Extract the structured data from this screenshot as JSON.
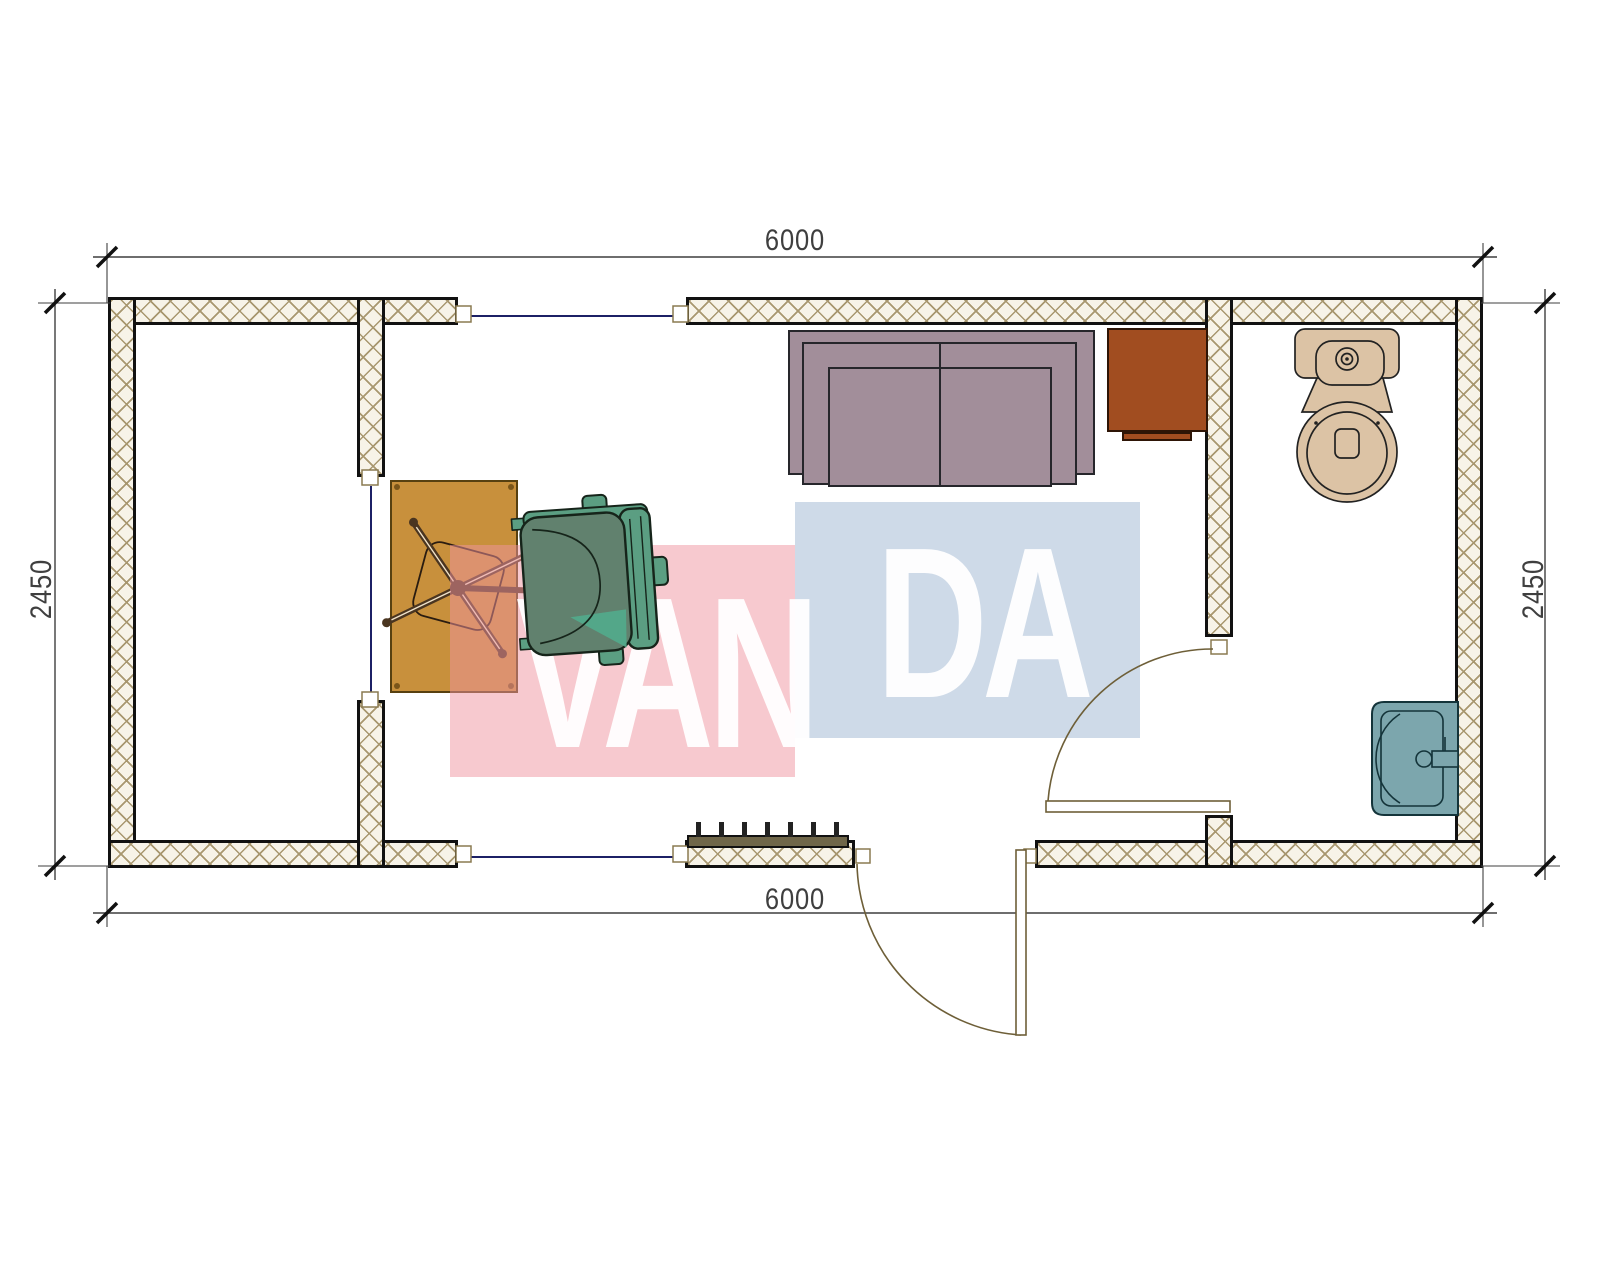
{
  "title": "Container office floor plan with bathroom",
  "dimensions": {
    "top": "6000",
    "bottom": "6000",
    "left": "2450",
    "right": "2450"
  },
  "watermark": {
    "text": "VANDA",
    "left_part": "VAN",
    "right_part": "DA"
  },
  "colors": {
    "wall_fill": "#f7f3e8",
    "wall_hatch": "#a8976f",
    "wall_border": "#111111",
    "window_line": "#1c2065",
    "door_line": "#6e5f38",
    "jamb_line": "#8a7a50",
    "dim_color": "#3f3f3f",
    "desk": "#c8903c",
    "desk_border": "#574010",
    "sofa": "#a28e9a",
    "sofa_border": "#26262b",
    "cabinet": "#a14d20",
    "cabinet_border": "#2e1506",
    "chair_seat": "#61816e",
    "chair_back": "#5b9e82",
    "chair_accent": "#52ab8c",
    "chair_line": "#16241a",
    "chair_base": "#4a3520",
    "toilet": "#dcc3a5",
    "fixture_line": "#222222",
    "sink": "#7ca6ad",
    "sink_line": "#14343a",
    "radiator": "#6f6649",
    "wm_pink": "rgba(239,147,159,0.5)",
    "wm_blue": "rgba(166,188,214,0.55)",
    "wm_letter": "rgba(255,255,255,0.95)"
  }
}
